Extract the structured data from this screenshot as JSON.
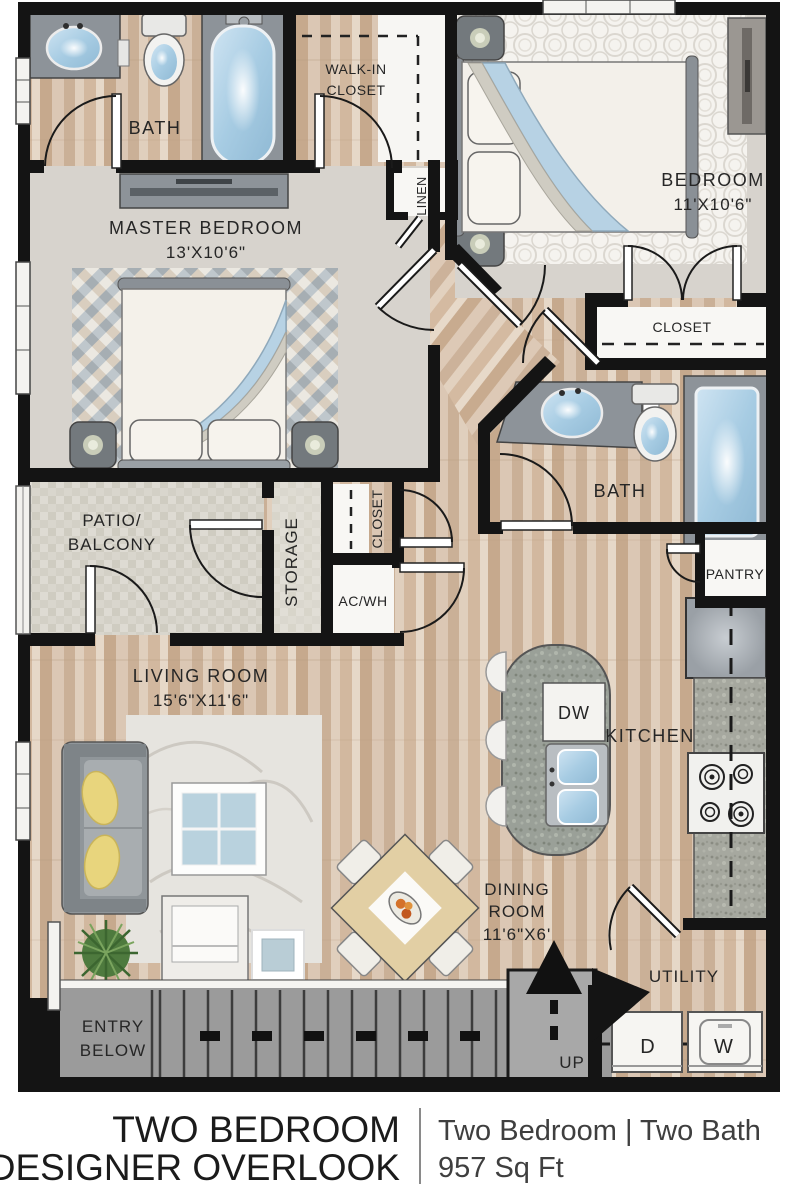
{
  "plan_type": "floorplan",
  "labels": {
    "bath_master": "BATH",
    "walk_in_1": "WALK-IN",
    "walk_in_2": "CLOSET",
    "linen": "LINEN",
    "bedroom2_name": "BEDROOM",
    "bedroom2_dims": "11'X10'6\"",
    "master_name": "MASTER BEDROOM",
    "master_dims": "13'X10'6\"",
    "closet_bedroom2": "CLOSET",
    "bath2": "BATH",
    "pantry": "PANTRY",
    "patio_1": "PATIO/",
    "patio_2": "BALCONY",
    "storage": "STORAGE",
    "hall_closet": "CLOSET",
    "ac_wh": "AC/WH",
    "living_name": "LIVING ROOM",
    "living_dims": "15'6\"X11'6\"",
    "dw": "DW",
    "kitchen": "KITCHEN",
    "dining_1": "DINING",
    "dining_2": "ROOM",
    "dining_dims": "11'6\"X6'",
    "utility": "UTILITY",
    "entry_1": "ENTRY",
    "entry_2": "BELOW",
    "up": "UP",
    "dryer": "D",
    "washer": "W"
  },
  "footer": {
    "title_line1": "TWO BEDROOM",
    "title_line2": "DESIGNER OVERLOOK",
    "subtitle_line1": "Two Bedroom | Two Bath",
    "subtitle_line2": "957 Sq Ft"
  },
  "colors": {
    "wall": "#141414",
    "wood_floor": "#d7c1ac",
    "carpet": "#d7d3cd",
    "patio_stone": "#d9d6cd",
    "fixture_blue": "#a7cce3",
    "counter_gray": "#8d9399",
    "stairs_gray": "#9b9b9b",
    "pillow_yellow": "#e8d57d",
    "plant_green": "#4e7a3e"
  }
}
